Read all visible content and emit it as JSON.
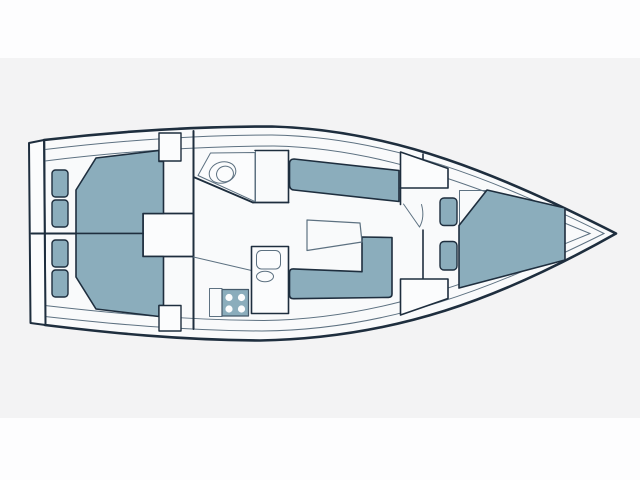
{
  "diagram": {
    "type": "sailboat-interior-floor-plan",
    "orientation": "bow-right",
    "colors": {
      "page_band": "#fdfdfe",
      "background": "#f3f3f4",
      "hull_fill": "#f9fafb",
      "fixture_fill": "#fbfcfd",
      "furniture_fill": "#8badbc",
      "outline": "#1e2e3e",
      "thin_line": "#5d7181"
    },
    "regions": [
      {
        "id": "transom"
      },
      {
        "id": "aft-cabin-port",
        "furniture": [
          "double-berth",
          "cushions",
          "locker"
        ]
      },
      {
        "id": "aft-cabin-starboard",
        "furniture": [
          "double-berth",
          "cushions",
          "locker"
        ]
      },
      {
        "id": "companionway-engine-box"
      },
      {
        "id": "head",
        "furniture": [
          "toilet",
          "counter"
        ]
      },
      {
        "id": "salon",
        "furniture": [
          "settee",
          "l-settee",
          "table",
          "nav-locker"
        ]
      },
      {
        "id": "galley",
        "furniture": [
          "stove",
          "sink",
          "counter"
        ]
      },
      {
        "id": "fore-cabin",
        "furniture": [
          "v-berth",
          "cushions",
          "lockers",
          "door"
        ]
      }
    ]
  }
}
